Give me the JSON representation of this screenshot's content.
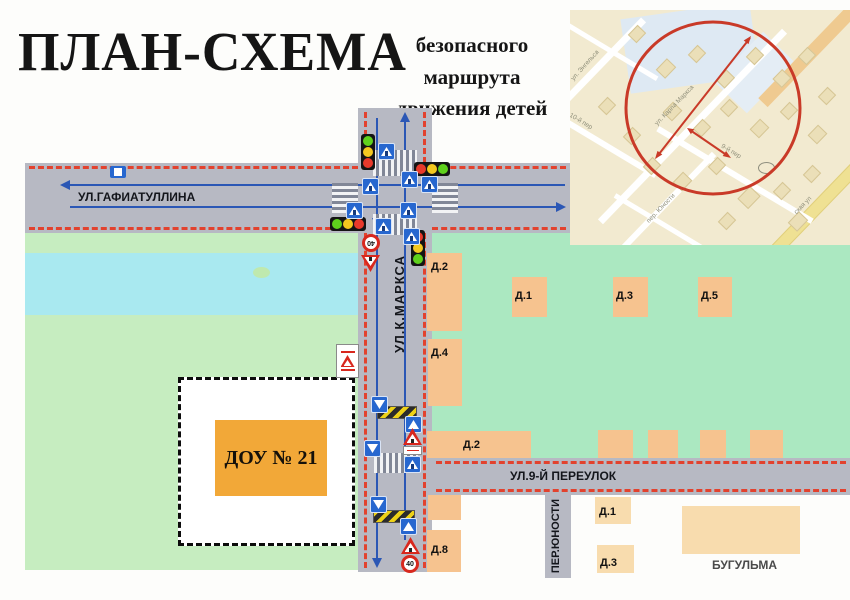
{
  "page": {
    "title": "ПЛАН-СХЕМА",
    "subtitle_line1": "безопасного маршрута",
    "subtitle_line2": "движения детей"
  },
  "streets": {
    "gafiatullina": "УЛ.ГАФИАТУЛЛИНА",
    "karla_marksa": "УЛ.К.МАРКСА",
    "pereulok_9": "УЛ.9-Й ПЕРЕУЛОК",
    "yunosti": "ПЕР.ЮНОСТИ"
  },
  "landmarks": {
    "kindergarten": "ДОУ № 21",
    "bugulma": "БУГУЛЬМА"
  },
  "buildings": {
    "d2_upper": "Д.2",
    "d1_upper": "Д.1",
    "d3_upper": "Д.3",
    "d5_upper": "Д.5",
    "d4": "Д.4",
    "d2_mid": "Д.2",
    "d8": "Д.8",
    "d1_lower": "Д.1",
    "d3_lower": "Д.3"
  },
  "signs": {
    "speed_limit": "40"
  },
  "inset": {
    "labels": {
      "engelsa": "ул. Энгельса",
      "per_10": "10-й пер",
      "karla_marksa": "ул. Карла Маркса",
      "per_9": "9-й пер",
      "yunosti": "пер. Юности",
      "skaya_ul": "ская ул"
    }
  },
  "palette": {
    "road": "#b7b9c3",
    "route_dash": "#e2422e",
    "lane_arrow": "#2b57b5",
    "green_left": "#c6edc0",
    "green_right": "#abe8c1",
    "water": "#a9e9f0",
    "building": "#f6c38f",
    "building_light": "#f8dcae",
    "kindergarten_fill": "#f2a838",
    "signal_red": "#e8392b",
    "signal_yellow": "#f4c81f",
    "signal_green": "#5fd11c",
    "inset_circle": "#c93a28"
  }
}
